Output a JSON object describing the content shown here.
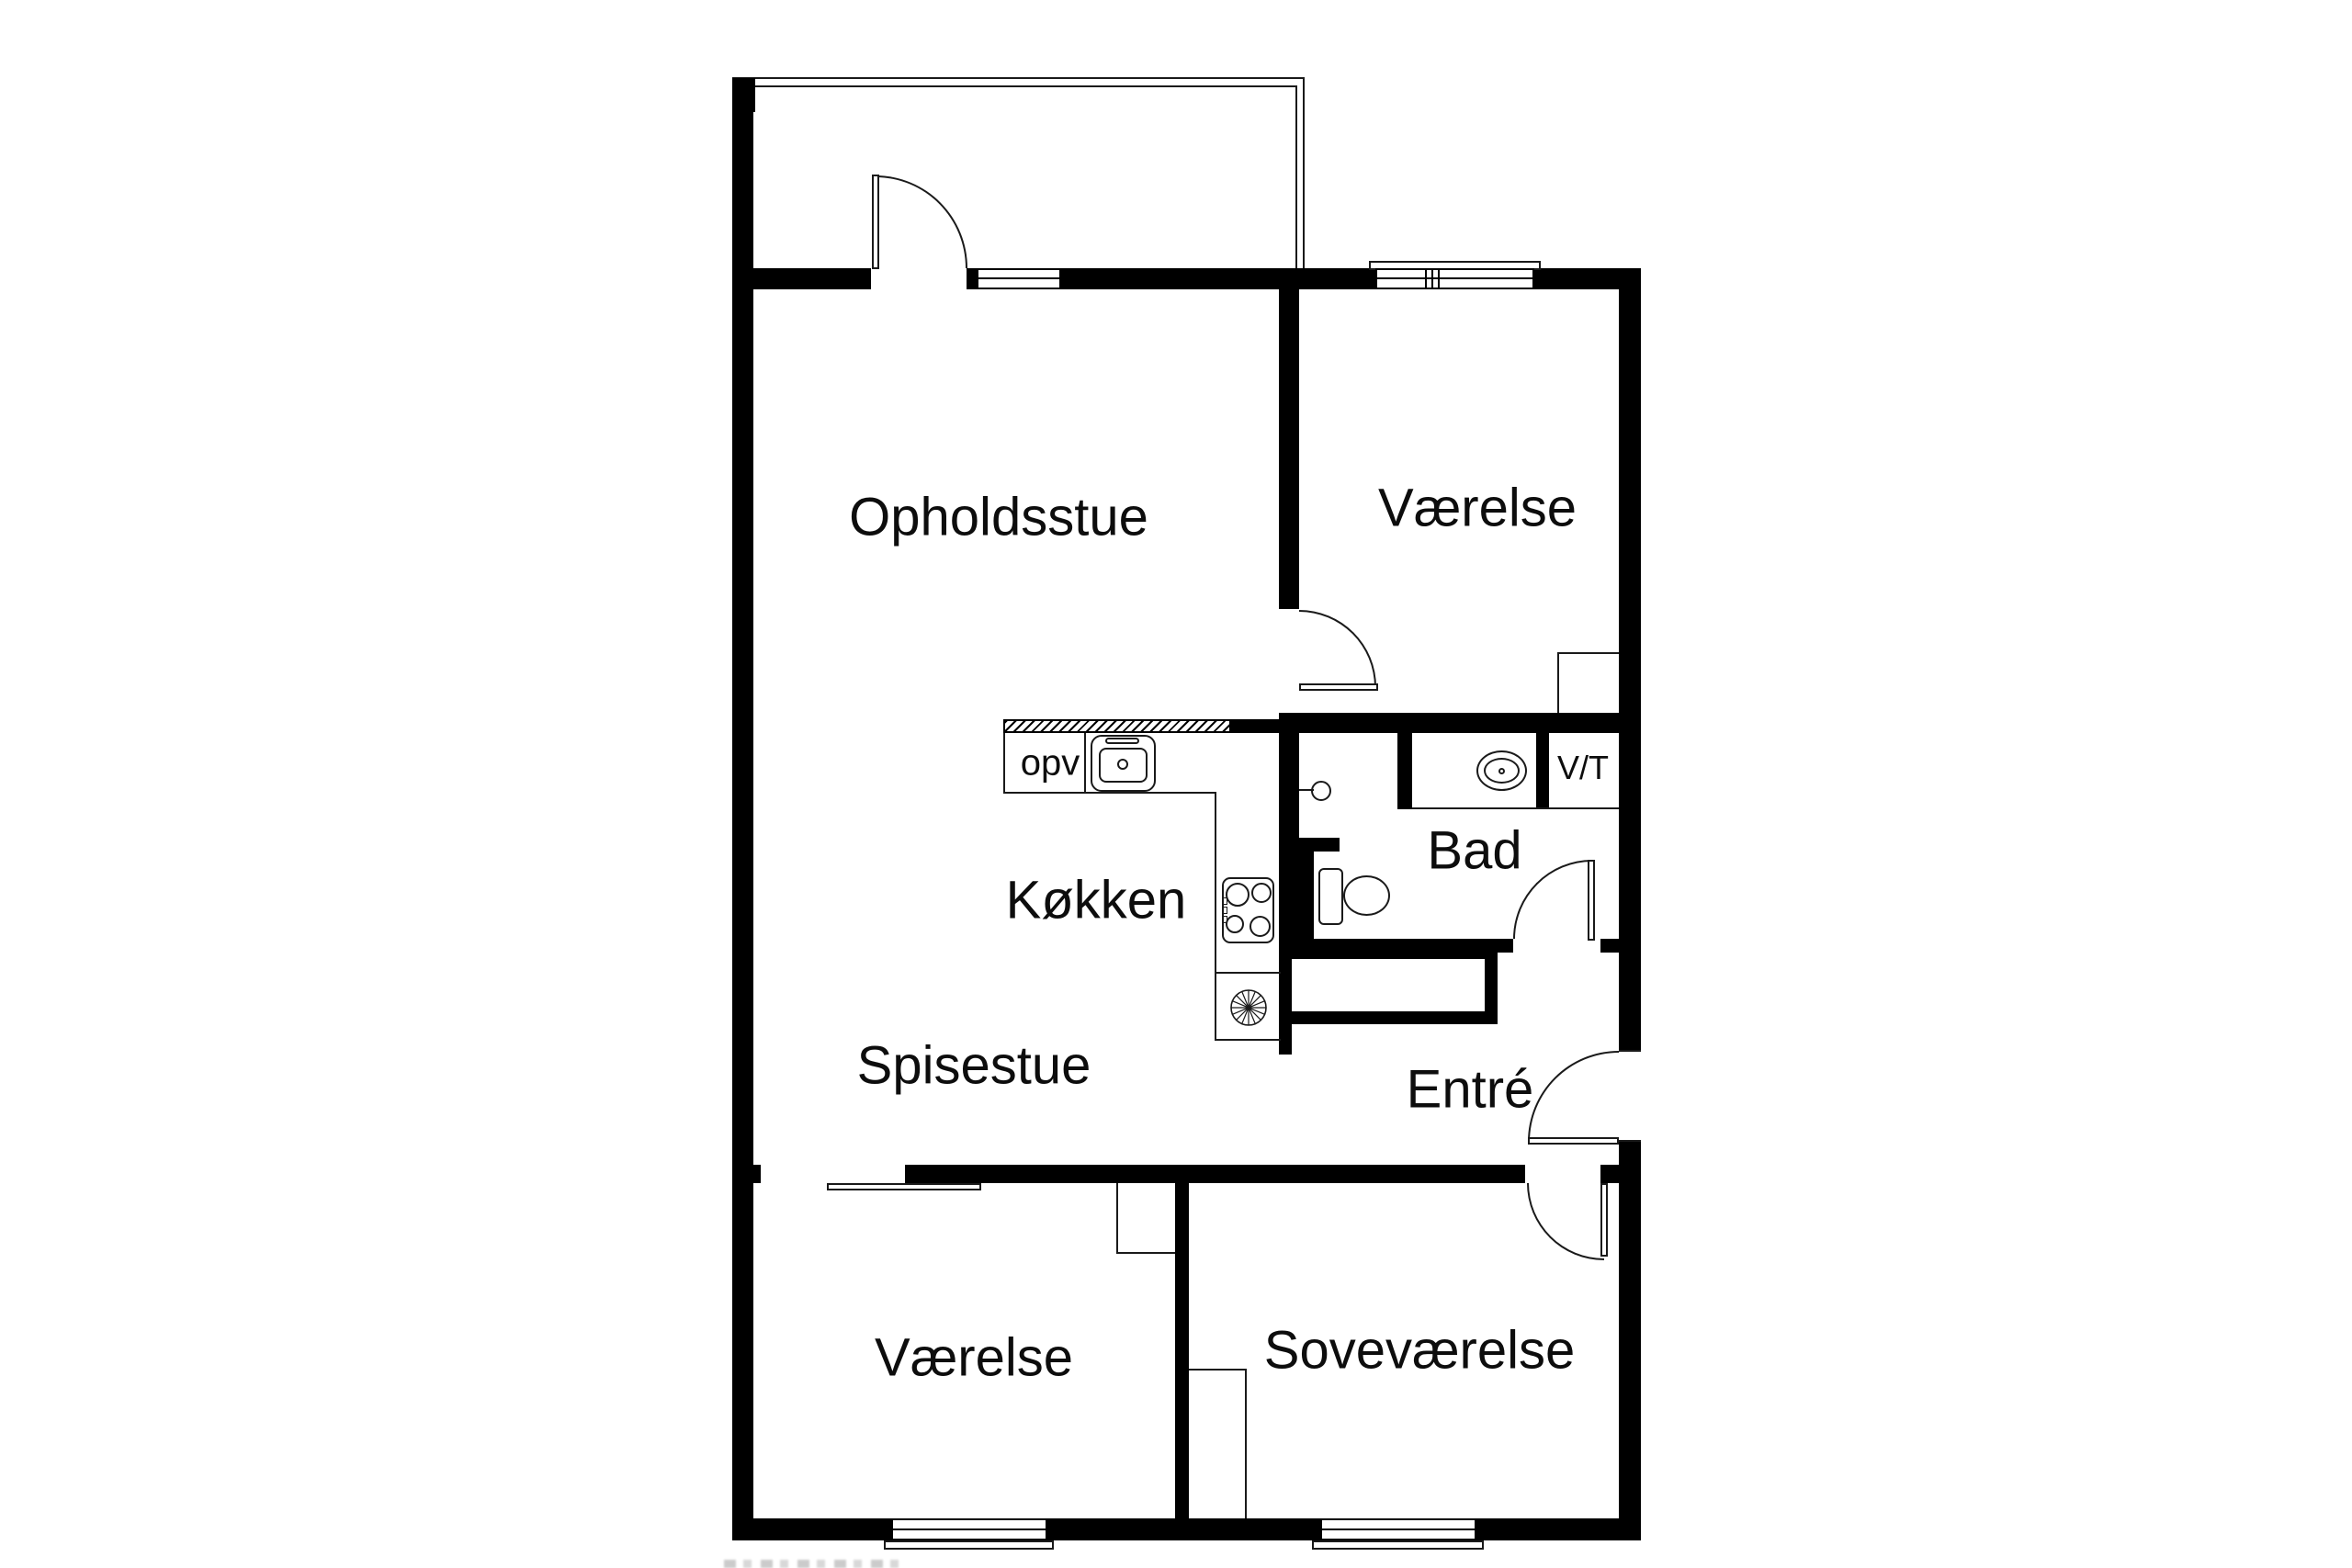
{
  "plan": {
    "title": "Apartment floor plan",
    "rooms": [
      {
        "id": "opholdsstue",
        "label": "Opholdsstue"
      },
      {
        "id": "vaerelse-top",
        "label": "Værelse"
      },
      {
        "id": "koekken",
        "label": "Køkken"
      },
      {
        "id": "bad",
        "label": "Bad"
      },
      {
        "id": "spisestue",
        "label": "Spisestue"
      },
      {
        "id": "entre",
        "label": "Entré"
      },
      {
        "id": "vaerelse-bottom",
        "label": "Værelse"
      },
      {
        "id": "sovevaerelse",
        "label": "Soveværelse"
      }
    ],
    "fixture_labels": {
      "dishwasher": "opv",
      "washer_dryer": "V/T"
    },
    "fixtures": [
      "balcony",
      "balcony-door",
      "kitchen-counter",
      "kitchen-sink",
      "stove",
      "extractor-fan",
      "washbasin",
      "toilet",
      "shower",
      "entry-door",
      "bathroom-door",
      "bedroom-door",
      "room-door",
      "sliding-door",
      "window",
      "closet"
    ],
    "colors": {
      "wall": "#000000",
      "line": "#1a1a1a",
      "background": "#ffffff"
    }
  }
}
